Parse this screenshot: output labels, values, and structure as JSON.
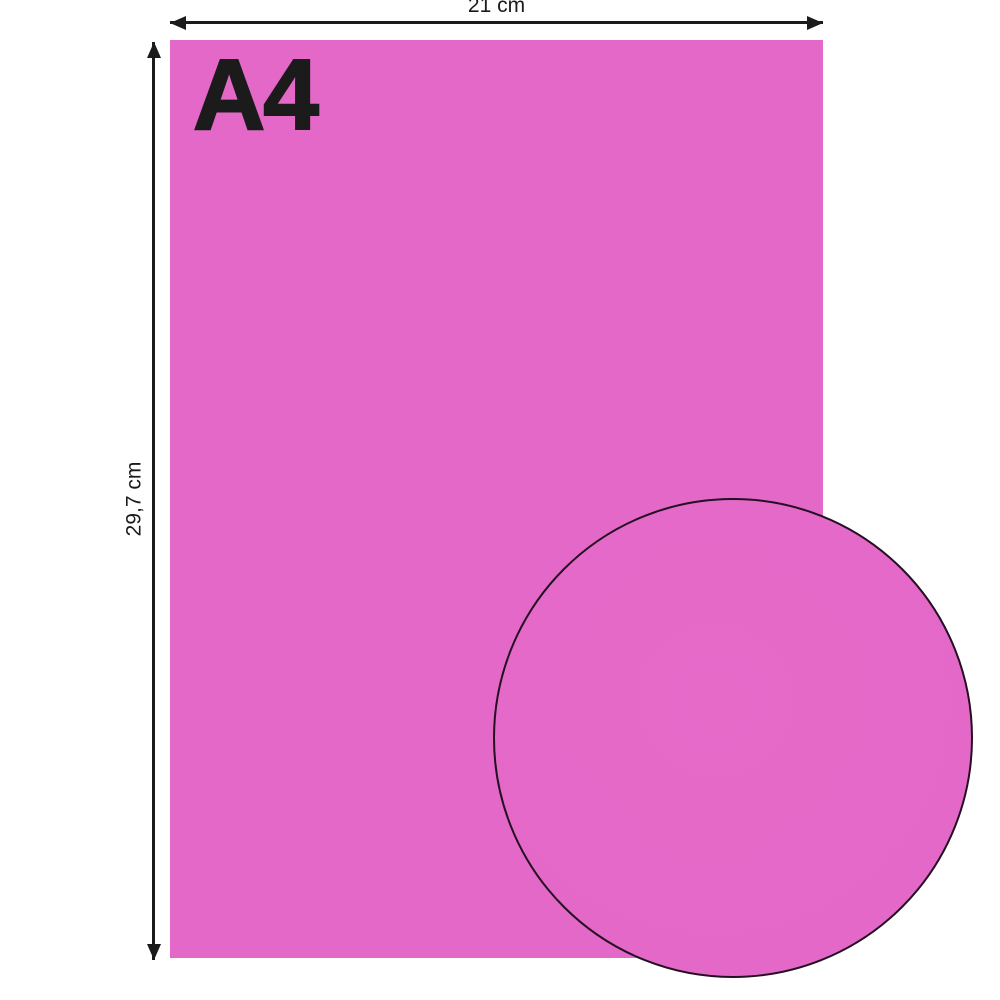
{
  "paper": {
    "format_label": "A4",
    "width_label": "21 cm",
    "height_label": "29,7 cm"
  },
  "colors": {
    "paper_pink": "#e468c7",
    "circle_pink": "#e66bc9",
    "ink": "#1b1b1b",
    "circle_outline": "#241022",
    "background": "#ffffff"
  }
}
